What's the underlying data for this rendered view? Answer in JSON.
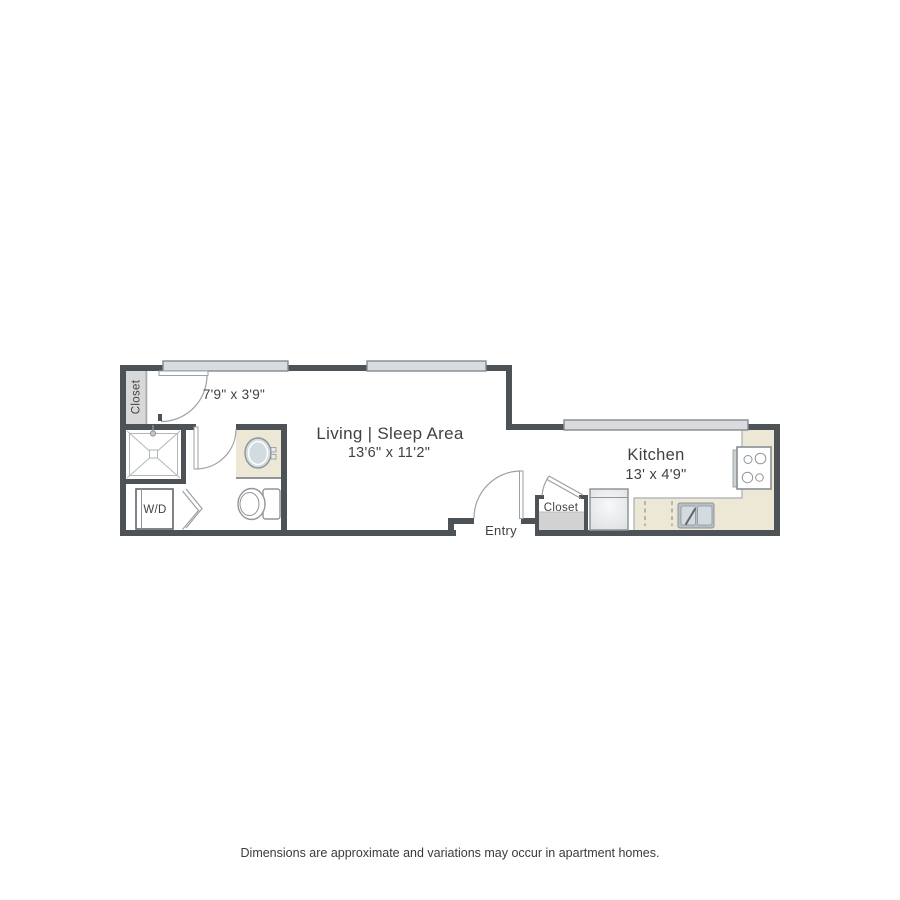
{
  "labels": {
    "living_name": "Living | Sleep Area",
    "living_dims": "13'6\" x 11'2\"",
    "kitchen_name": "Kitchen",
    "kitchen_dims": "13' x 4'9\"",
    "bath_dims": "7'9\" x 3'9\"",
    "entry": "Entry",
    "entry_closet": "Closet",
    "bath_closet": "Closet",
    "washer_dryer": "W/D"
  },
  "disclaimer": "Dimensions are approximate and variations may occur in apartment homes.",
  "fixtures": {
    "shower": "square-with-x-and-drain",
    "washer_dryer": "box-with-bifold-door",
    "vanity_sink": "oval-basin-on-beige-counter",
    "toilet": "bowl-with-tank",
    "refrigerator": "gradient-box",
    "dishwasher": "dashed-outline-in-counter",
    "kitchen_sink": "double-basin-with-faucet",
    "stove": "four-burner-cooktop",
    "windows": "light-gray-bars-in-wall",
    "doors": "quarter-circle-swing-arcs"
  },
  "colors": {
    "wall": "#4d5257",
    "window_fill": "#d8dcde",
    "window_stroke": "#848a8e",
    "counter_beige": "#ede7d5",
    "closet_gray": "#d8d8d8",
    "shelf_gray": "#d2d2d2",
    "fixture_stroke": "#8f959a",
    "light_stroke": "#b2b7ba",
    "door_stroke": "#9ba1a5",
    "counter_edge": "#a9aeb2",
    "basin_fill": "#d2dbdf",
    "sink_outer": "#b9bfc3",
    "text": "#3f4245",
    "disclaimer_text": "#3a3a3a",
    "background": "#ffffff"
  }
}
